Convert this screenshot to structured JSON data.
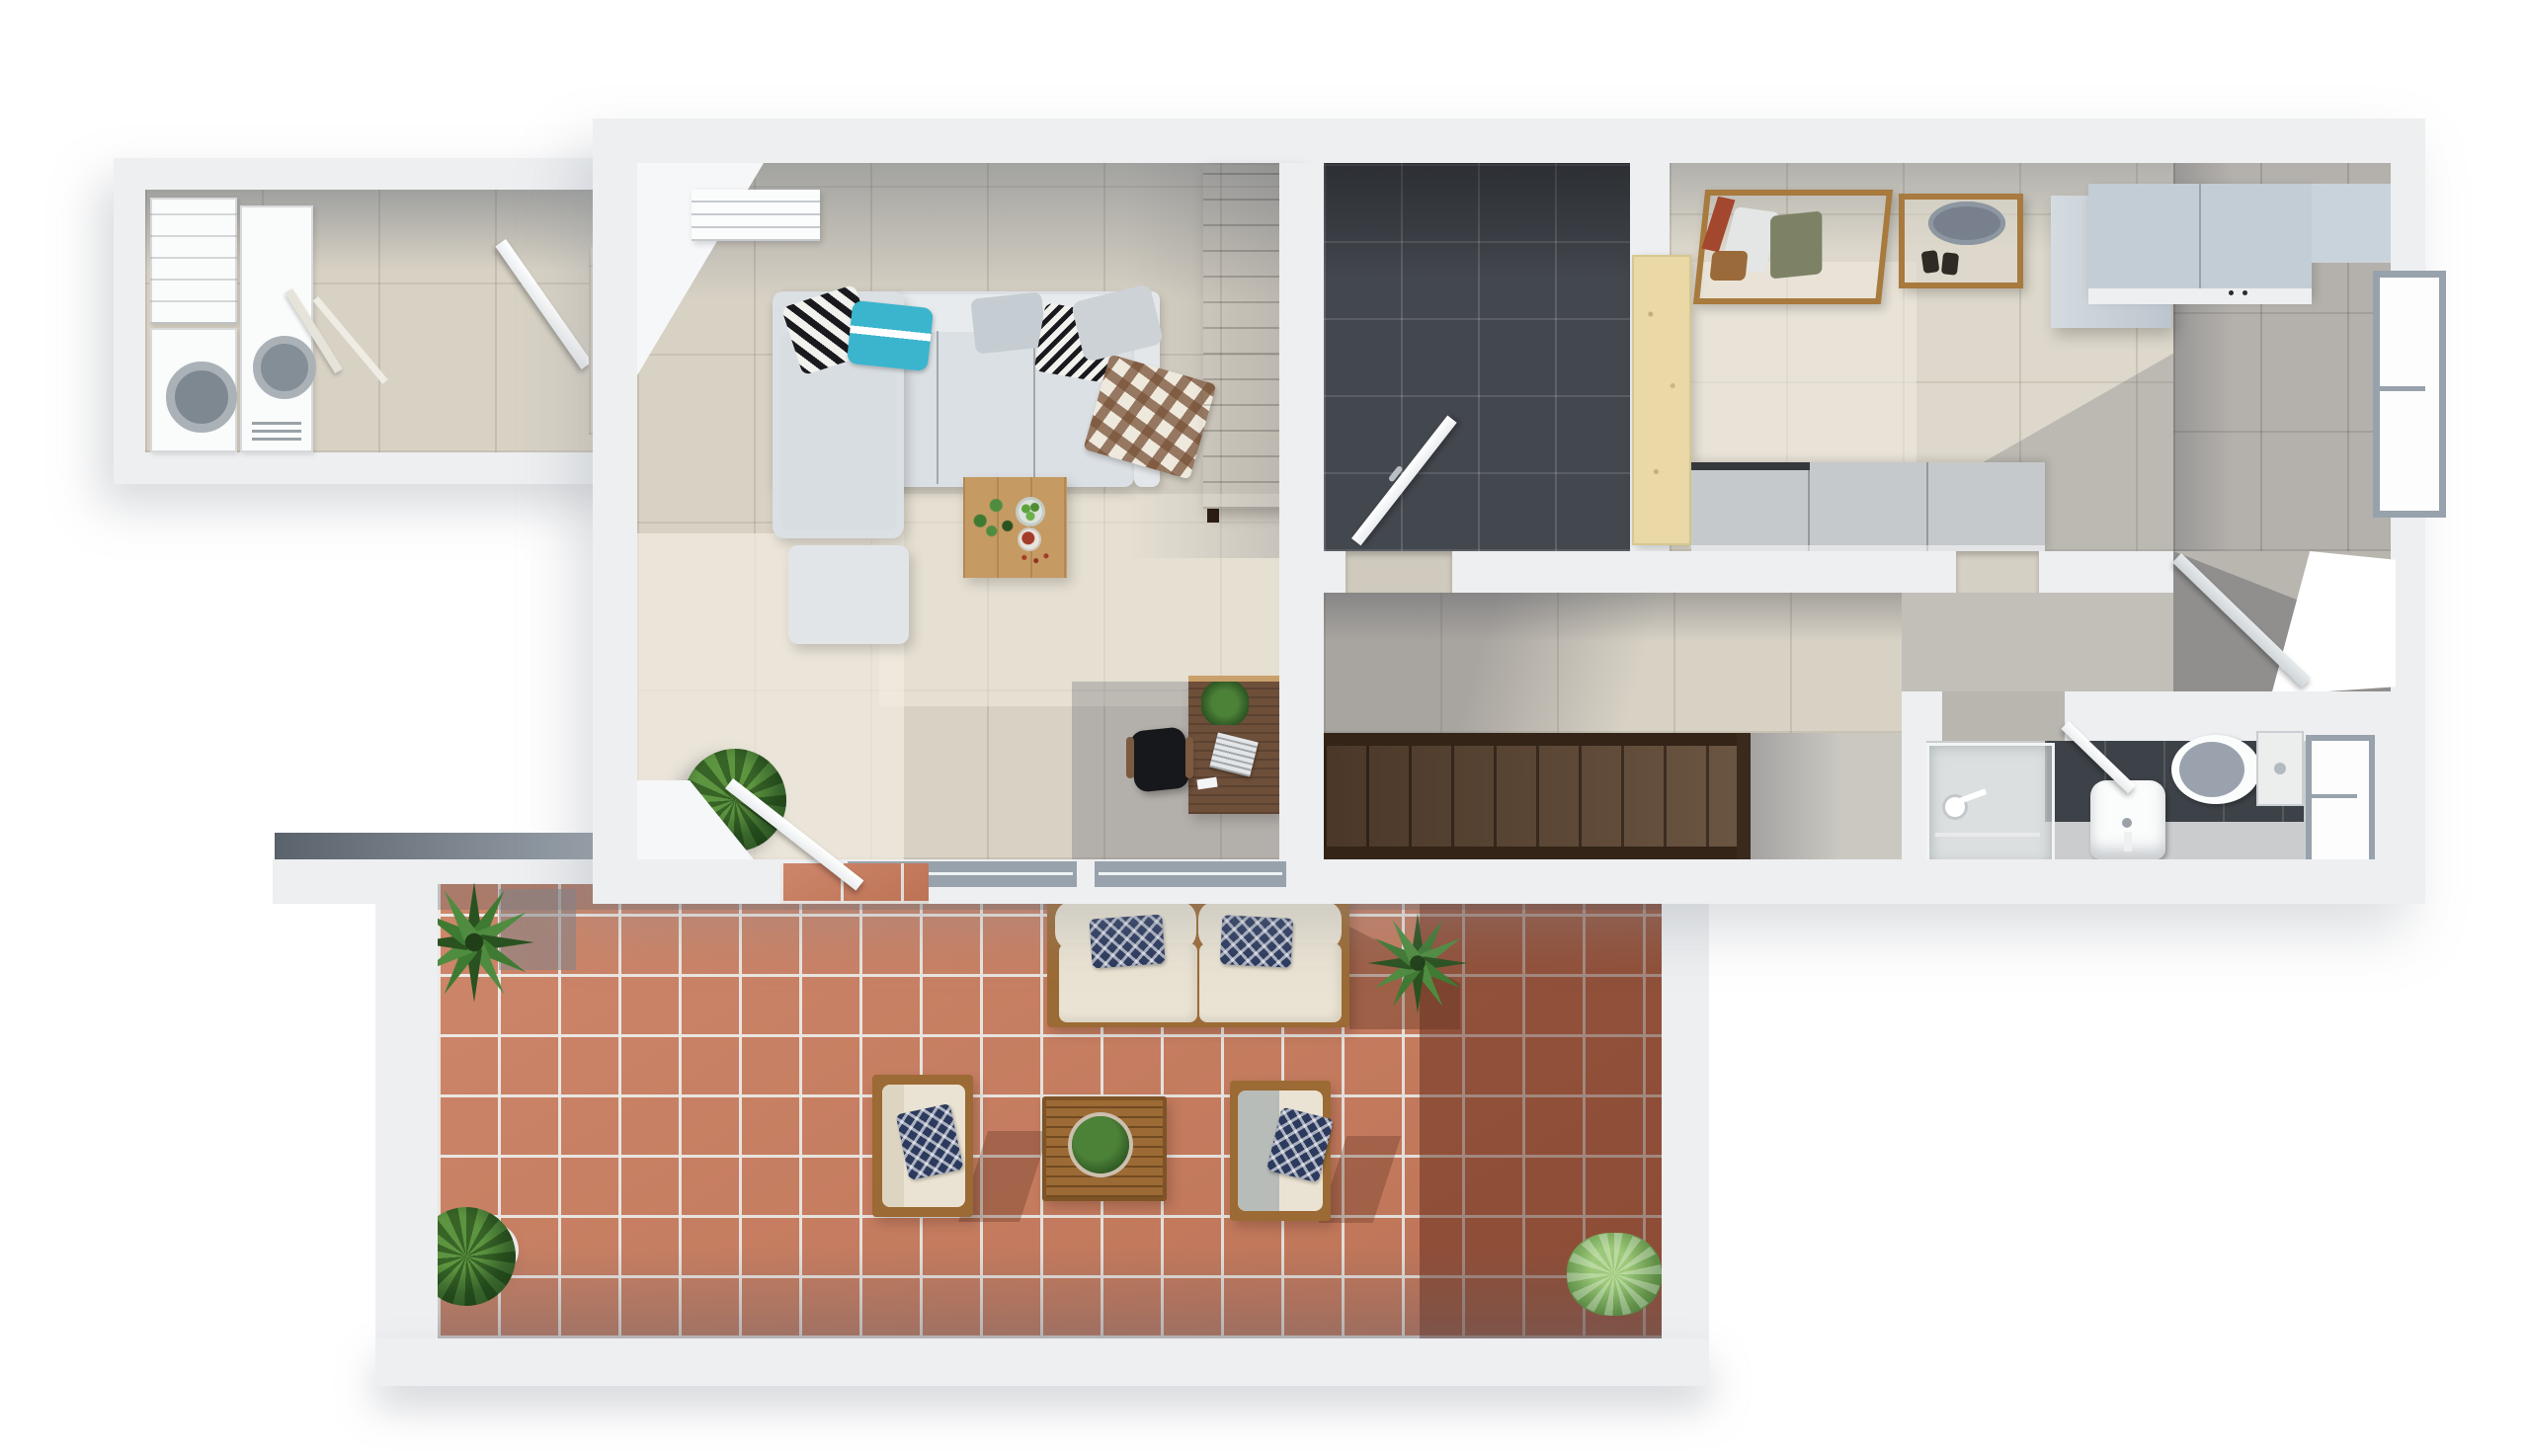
{
  "meta": {
    "title": "Top-down 3D render — single-storey apartment floor plan with terrace",
    "view": "top-down",
    "render_style": "photorealistic 3D floor plan, white background"
  },
  "palette": {
    "bg": "#ffffff",
    "wall": "#edeff1",
    "wallBright": "#f6f7f8",
    "wallShadowBand": "#5a626c",
    "floorBeige": "#d8d2c5",
    "floorBeigeLight": "#ece6d8",
    "floorGray": "#b4b1ac",
    "floorConcrete": "#cbc8c2",
    "darkTile": "#43474e",
    "terracotta": "#c8795a",
    "grout": "#ece7e2",
    "stairWood": "#5f4733",
    "stairRail": "#332417",
    "wardrobeWood": "#64422c",
    "deskWood": "#6d4f3a",
    "tableWood": "#c59a63",
    "outdoorWood": "#9c6a34",
    "rackWood": "#a87a3e",
    "sofaGray": "#dbe0e4",
    "cushionCream": "#eae3d3",
    "pillowNavy": "#2c3a5e",
    "pillowTeal": "#3ab5cd",
    "plantGreen": "#3f7a33",
    "plantDark": "#2a5220",
    "plantLight": "#79b05c",
    "glass": "#e3e8e8",
    "windowFrame": "#98a2ac",
    "fixtureWhite": "#fbfcfc"
  },
  "rooms": {
    "utility": {
      "label": "Utility room",
      "items": [
        "washer",
        "dryer",
        "storage shelves",
        "open door"
      ]
    },
    "living": {
      "label": "Living and dining room",
      "items": [
        "L-shaped gray sofa",
        "ottoman",
        "striped pillow",
        "teal pillow",
        "chevron pillow",
        "plaid blanket",
        "wooden dining table",
        "bowl of green fruit",
        "bowl of berries",
        "tall dark wardrobe",
        "round potted plant",
        "desk with laptop",
        "office chair",
        "radiator",
        "door to terrace",
        "windows to terrace"
      ]
    },
    "shower_room": {
      "label": "Dark tiled shower room",
      "items": [
        "open white door"
      ]
    },
    "dressing": {
      "label": "Bedroom / dressing room",
      "items": [
        "pale wood panel",
        "clothes rack with hangers and shoes",
        "wooden shoe shelf",
        "gray hat box",
        "row of low gray cabinets"
      ]
    },
    "kitchen": {
      "label": "Kitchen",
      "items": [
        "counter with cooktop",
        "tall light cabinet",
        "window",
        "open door"
      ]
    },
    "hallway": {
      "label": "Hallway",
      "items": [
        "dark wooden staircase",
        "landing",
        "open door",
        "daylight opening"
      ]
    },
    "bathroom": {
      "label": "Bathroom",
      "items": [
        "glass shower cabin",
        "shower head",
        "washbasin",
        "toilet",
        "window",
        "open door"
      ]
    },
    "terrace": {
      "label": "Terrace",
      "items": [
        "terracotta tiles",
        "outdoor two-seat sofa",
        "two armchairs",
        "ikat pillows",
        "slatted coffee table",
        "round planter",
        "agave plants",
        "leafy potted plant",
        "variegated potted plant"
      ]
    }
  }
}
